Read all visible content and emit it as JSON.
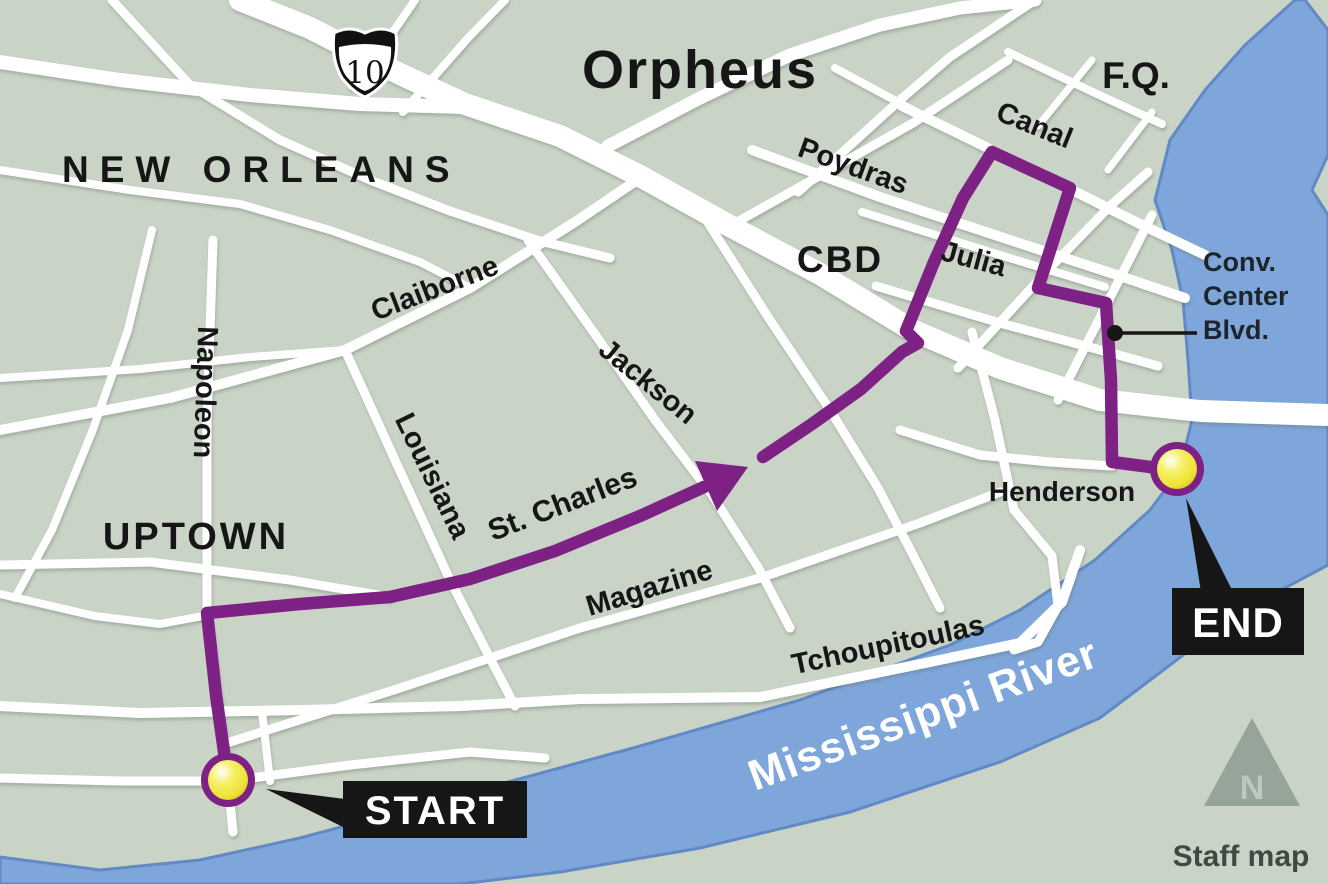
{
  "title": "Orpheus",
  "map": {
    "city": "NEW ORLEANS",
    "neighborhoods": {
      "uptown": "UPTOWN",
      "cbd": "CBD",
      "french_quarter": "F.Q."
    },
    "interstate_shield": "10",
    "streets": {
      "napoleon": "Napoleon",
      "claiborne": "Claiborne",
      "louisiana": "Louisiana",
      "jackson": "Jackson",
      "st_charles": "St. Charles",
      "magazine": "Magazine",
      "tchoupitoulas": "Tchoupitoulas",
      "poydras": "Poydras",
      "canal": "Canal",
      "julia": "Julia",
      "henderson": "Henderson"
    },
    "callout_conv_center_blvd": [
      "Conv.",
      "Center",
      "Blvd."
    ],
    "river": "Mississippi River",
    "route": {
      "start_label": "START",
      "end_label": "END"
    },
    "north_indicator": "N",
    "credit": "Staff map"
  },
  "colors": {
    "land": "#c9d3c6",
    "road": "#ffffff",
    "route": "#7d2185",
    "river": "#7fa6db",
    "river_edge": "#6189c5",
    "marker_yellow": "#f2ea3d",
    "label_black": "#161616"
  }
}
